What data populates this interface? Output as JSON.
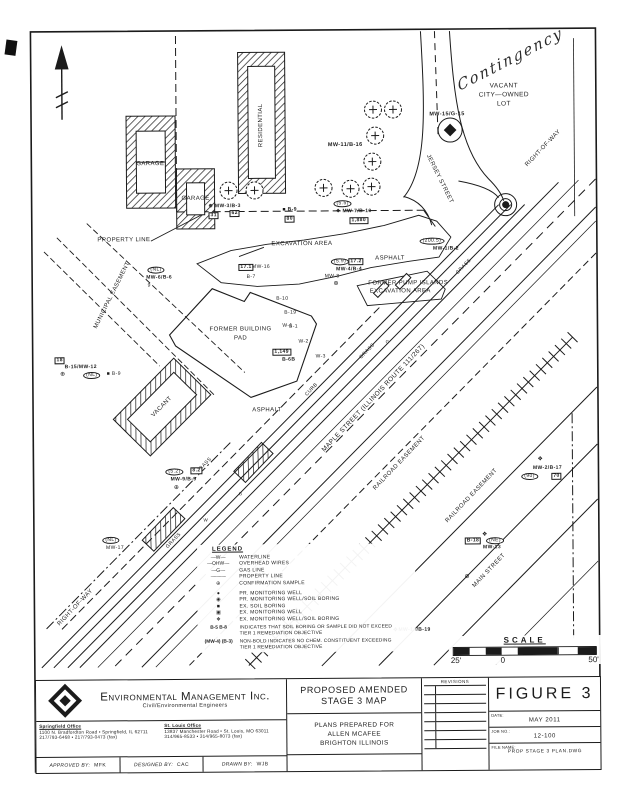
{
  "colors": {
    "ink": "#1b1b1b",
    "paper": "#ffffff"
  },
  "note_handwritten": "Contingency",
  "map": {
    "labels": [
      {
        "text": "VACANT",
        "x": 506,
        "y": 88,
        "fs": 6.5
      },
      {
        "text": "CITY—OWNED",
        "x": 506,
        "y": 97,
        "fs": 6.5
      },
      {
        "text": "LOT",
        "x": 506,
        "y": 106,
        "fs": 6.5
      },
      {
        "text": "RIGHT-OF-WAY",
        "x": 545,
        "y": 150,
        "fs": 6,
        "rot": -46
      },
      {
        "text": "JERSEY  STREET",
        "x": 441,
        "y": 180,
        "fs": 6,
        "rot": 64
      },
      {
        "text": "MW-15/G-15",
        "x": 449,
        "y": 116,
        "fs": 5.5,
        "cls": "b"
      },
      {
        "text": "MW-11/B-16",
        "x": 347,
        "y": 146,
        "fs": 5.5,
        "cls": "b"
      },
      {
        "text": "GARAGE",
        "x": 152,
        "y": 163,
        "fs": 6
      },
      {
        "text": "GARAGE",
        "x": 197,
        "y": 198,
        "fs": 6
      },
      {
        "text": "RESIDENTIAL",
        "x": 263,
        "y": 125,
        "fs": 6,
        "rot": -90
      },
      {
        "text": "PROPERTY LINE",
        "x": 125,
        "y": 239,
        "fs": 6
      },
      {
        "text": "EXCAVATION AREA",
        "x": 303,
        "y": 244,
        "fs": 6
      },
      {
        "text": "ASPHALT",
        "x": 391,
        "y": 259,
        "fs": 6
      },
      {
        "text": "FORMER PUMP ISLANDS",
        "x": 409,
        "y": 284,
        "fs": 6
      },
      {
        "text": "EXCAVATION AREA",
        "x": 401,
        "y": 292,
        "fs": 6
      },
      {
        "text": "FORMER BUILDING",
        "x": 241,
        "y": 329,
        "fs": 6
      },
      {
        "text": "PAD",
        "x": 241,
        "y": 338,
        "fs": 6
      },
      {
        "text": "MUNICIPAL EASEMENT",
        "x": 113,
        "y": 294,
        "fs": 6,
        "rot": -63
      },
      {
        "text": "ASPHALT",
        "x": 267,
        "y": 410,
        "fs": 6
      },
      {
        "text": "VACANT",
        "x": 162,
        "y": 406,
        "fs": 6,
        "rot": -45
      },
      {
        "text": "MAPLE STREET (ILLINOIS ROUTE 111/267)",
        "x": 374,
        "y": 399,
        "fs": 6.5,
        "rot": -46
      },
      {
        "text": "RAILROAD EASEMENT",
        "x": 399,
        "y": 464,
        "fs": 6,
        "rot": -46
      },
      {
        "text": "RAILROAD EASEMENT",
        "x": 471,
        "y": 497,
        "fs": 6,
        "rot": -46
      },
      {
        "text": "MAIN STREET",
        "x": 488,
        "y": 572,
        "fs": 6,
        "rot": -46
      },
      {
        "text": "RIGHT-OF-WAY",
        "x": 74,
        "y": 606,
        "fs": 6,
        "rot": -46
      },
      {
        "text": "GRASS",
        "x": 465,
        "y": 268,
        "fs": 5,
        "rot": -46
      },
      {
        "text": "GRASS",
        "x": 368,
        "y": 352,
        "fs": 5,
        "rot": -46
      },
      {
        "text": "CURB",
        "x": 312,
        "y": 390,
        "fs": 5,
        "rot": -46
      },
      {
        "text": "GRASS",
        "x": 204,
        "y": 465,
        "fs": 5,
        "rot": -46
      },
      {
        "text": "GRASS",
        "x": 173,
        "y": 540,
        "fs": 5,
        "rot": -46
      },
      {
        "text": "⊕ MW-3/B-3",
        "x": 226,
        "y": 206,
        "fs": 5,
        "cls": "b"
      },
      {
        "text": "31",
        "x": 215,
        "y": 215,
        "fs": 5,
        "cls": "box"
      },
      {
        "text": "62",
        "x": 236,
        "y": 213,
        "fs": 5,
        "cls": "box"
      },
      {
        "text": "■ B-9",
        "x": 291,
        "y": 210,
        "fs": 5,
        "cls": "b"
      },
      {
        "text": "80",
        "x": 291,
        "y": 219,
        "fs": 5,
        "cls": "box"
      },
      {
        "text": "(5.5)",
        "x": 344,
        "y": 204,
        "fs": 5,
        "cls": "oval"
      },
      {
        "text": "❖ MW-7/B-10",
        "x": 355,
        "y": 212,
        "fs": 5,
        "cls": "b"
      },
      {
        "text": "1,880",
        "x": 360,
        "y": 221,
        "fs": 5,
        "cls": "box"
      },
      {
        "text": "(200.5)",
        "x": 433,
        "y": 242,
        "fs": 5,
        "cls": "oval"
      },
      {
        "text": "MW-1/B-2",
        "x": 447,
        "y": 250,
        "fs": 5,
        "cls": "b"
      },
      {
        "text": "(5.9)",
        "x": 341,
        "y": 262,
        "fs": 5,
        "cls": "oval"
      },
      {
        "text": "17.2",
        "x": 357,
        "y": 262,
        "fs": 5,
        "cls": "box"
      },
      {
        "text": "MW-4/B-4",
        "x": 350,
        "y": 270,
        "fs": 5,
        "cls": "b"
      },
      {
        "text": "MW-8",
        "x": 333,
        "y": 277,
        "fs": 5
      },
      {
        "text": "⊕",
        "x": 337,
        "y": 284,
        "fs": 6
      },
      {
        "text": "(NL)",
        "x": 157,
        "y": 269,
        "fs": 5,
        "cls": "oval"
      },
      {
        "text": "MW-6/B-6",
        "x": 160,
        "y": 277,
        "fs": 5,
        "cls": "b"
      },
      {
        "text": "9",
        "x": 150,
        "y": 285,
        "fs": 5
      },
      {
        "text": "17.1",
        "x": 247,
        "y": 267,
        "fs": 5,
        "cls": "box"
      },
      {
        "text": "MW-16",
        "x": 262,
        "y": 267,
        "fs": 5
      },
      {
        "text": "B-7",
        "x": 252,
        "y": 277,
        "fs": 5
      },
      {
        "text": "B-10",
        "x": 283,
        "y": 299,
        "fs": 5
      },
      {
        "text": "B-19",
        "x": 291,
        "y": 313,
        "fs": 5
      },
      {
        "text": "B-1",
        "x": 294,
        "y": 327,
        "fs": 5
      },
      {
        "text": "W-1",
        "x": 288,
        "y": 326,
        "fs": 5
      },
      {
        "text": "W-2",
        "x": 304,
        "y": 342,
        "fs": 5
      },
      {
        "text": "W-3",
        "x": 321,
        "y": 357,
        "fs": 5
      },
      {
        "text": "1,149",
        "x": 282,
        "y": 352,
        "fs": 5,
        "cls": "box"
      },
      {
        "text": "B-6B",
        "x": 289,
        "y": 360,
        "fs": 5,
        "cls": "b"
      },
      {
        "text": "18",
        "x": 60,
        "y": 359,
        "fs": 5,
        "cls": "box"
      },
      {
        "text": "B-15/MW-12",
        "x": 81,
        "y": 366,
        "fs": 5,
        "cls": "b"
      },
      {
        "text": "⊕",
        "x": 63,
        "y": 373,
        "fs": 6
      },
      {
        "text": "(NL)",
        "x": 92,
        "y": 374,
        "fs": 5,
        "cls": "oval"
      },
      {
        "text": "■ B-9",
        "x": 114,
        "y": 373,
        "fs": 5
      },
      {
        "text": "(5.2)",
        "x": 174,
        "y": 471,
        "fs": 5,
        "cls": "oval"
      },
      {
        "text": "8.2",
        "x": 196,
        "y": 470,
        "fs": 5,
        "cls": "box"
      },
      {
        "text": "MW-9/B-9",
        "x": 183,
        "y": 479,
        "fs": 5,
        "cls": "b"
      },
      {
        "text": "⊕",
        "x": 176,
        "y": 487,
        "fs": 6
      },
      {
        "text": "(NL)",
        "x": 110,
        "y": 539,
        "fs": 5,
        "cls": "oval"
      },
      {
        "text": "MW-17",
        "x": 114,
        "y": 547,
        "fs": 5
      },
      {
        "text": "❖",
        "x": 540,
        "y": 461,
        "fs": 6
      },
      {
        "text": "MW-2/B-17",
        "x": 547,
        "y": 470,
        "fs": 5,
        "cls": "b"
      },
      {
        "text": "(90)",
        "x": 529,
        "y": 478,
        "fs": 5,
        "cls": "oval"
      },
      {
        "text": "70",
        "x": 556,
        "y": 478,
        "fs": 5,
        "cls": "box"
      },
      {
        "text": "B-18",
        "x": 472,
        "y": 542,
        "fs": 5,
        "cls": "box"
      },
      {
        "text": "❖",
        "x": 484,
        "y": 536,
        "fs": 6
      },
      {
        "text": "(NE)",
        "x": 494,
        "y": 542,
        "fs": 5,
        "cls": "oval"
      },
      {
        "text": "MW-13",
        "x": 491,
        "y": 549,
        "fs": 5,
        "cls": "b"
      },
      {
        "text": "❖",
        "x": 394,
        "y": 631,
        "fs": 6
      },
      {
        "text": "MW-14/B-19",
        "x": 413,
        "y": 631,
        "fs": 5,
        "cls": "b"
      },
      {
        "text": "⊕",
        "x": 466,
        "y": 578,
        "fs": 6
      },
      {
        "text": "G",
        "x": 388,
        "y": 343,
        "fs": 4.5
      },
      {
        "text": "G",
        "x": 240,
        "y": 494,
        "fs": 4.5
      },
      {
        "text": "W",
        "x": 205,
        "y": 520,
        "fs": 4.5
      }
    ],
    "trees": [
      [
        230,
        190
      ],
      [
        256,
        190
      ],
      [
        325,
        188
      ],
      [
        352,
        189
      ],
      [
        375,
        110
      ],
      [
        377,
        136
      ],
      [
        374,
        162
      ],
      [
        373,
        187
      ],
      [
        395,
        110
      ]
    ],
    "railroad": {
      "x1": 573,
      "y1": 339,
      "x2": 247,
      "y2": 665,
      "tick_half": 7,
      "tick_gap": 9
    },
    "legend": {
      "title": "LEGEND",
      "line_items": [
        {
          "symbol": "—W—",
          "label": "WATERLINE"
        },
        {
          "symbol": "—OHW—",
          "label": "OVERHEAD WIRES"
        },
        {
          "symbol": "—G—",
          "label": "GAS LINE"
        },
        {
          "symbol": "———",
          "label": "PROPERTY LINE"
        },
        {
          "symbol": "⊕",
          "label": "CONFIRMATION SAMPLE"
        }
      ],
      "symbol_items": [
        {
          "symbol": "●",
          "label": "PR. MONITORING WELL"
        },
        {
          "symbol": "◉",
          "label": "PR. MONITORING WELL/SOIL BORING"
        },
        {
          "symbol": "■",
          "label": "EX. SOIL BORING"
        },
        {
          "symbol": "▣",
          "label": "EX. MONITORING WELL"
        },
        {
          "symbol": "❖",
          "label": "EX. MONITORING WELL/SOIL BORING"
        }
      ],
      "notes": [
        {
          "symbol": "B-5  B-8",
          "text": "INDICATES THAT SOIL BORING OR SAMPLE DID NOT EXCEED TIER 1 REMEDIATION OBJECTIVE"
        },
        {
          "symbol": "(MW-4) (B-3)",
          "text": "NON-BOLD INDICATES NO CHEM. CONSTITUENT EXCEEDING TIER 1 REMEDIATION OBJECTIVE"
        }
      ]
    },
    "scale": {
      "title": "SCALE",
      "left_label": "25'",
      "zero_label": "0",
      "right_label": "50'"
    }
  },
  "title_block": {
    "company": {
      "name": "Environmental Management Inc.",
      "tagline": "Civil/Environmental Engineers",
      "springfield_office_label": "Springfield Office",
      "springfield_address": "1100 N. Bradfordton Road • Springfield, IL 62711",
      "springfield_phone": "217/793-6468 • 217/793-0473 (fax)",
      "stlouis_office_label": "St. Louis Office",
      "stlouis_address": "13837 Manchester Road • St. Louis, MO 63011",
      "stlouis_phone": "314/965-8533 • 314/965-8073 (fax)",
      "approved_by_label": "APPROVED BY:",
      "approved_by": "MFK",
      "designed_by_label": "DESIGNED BY:",
      "designed_by": "CAC",
      "drawn_by_label": "DRAWN BY:",
      "drawn_by": "WJB"
    },
    "project": {
      "title_line1": "PROPOSED AMENDED",
      "title_line2": "STAGE 3 MAP",
      "prepared_for_line1": "PLANS PREPARED FOR",
      "prepared_for_line2": "ALLEN MCAFEE",
      "prepared_for_line3": "BRIGHTON ILLINOIS"
    },
    "revisions": {
      "header": "REVISIONS",
      "row_count": 7
    },
    "figure": {
      "number": "FIGURE 3",
      "date_label": "DATE:",
      "date": "MAY 2011",
      "job_label": "JOB NO.:",
      "job": "12-100",
      "file_label": "FILE NAME:",
      "file": "PROP STAGE 3 PLAN.DWG"
    }
  }
}
